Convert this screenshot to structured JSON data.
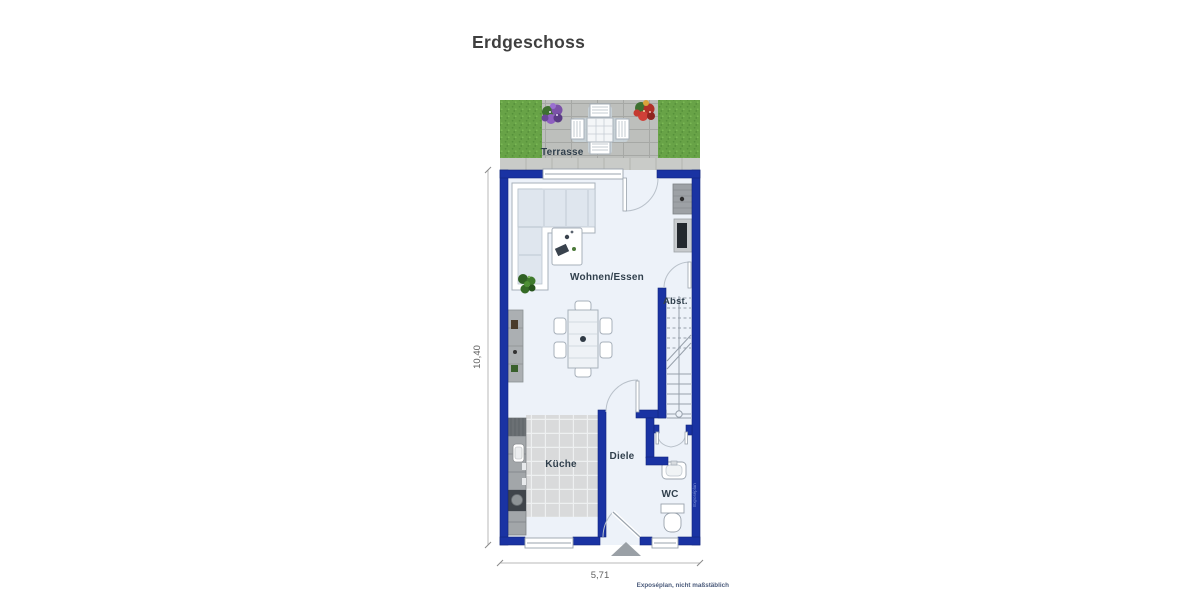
{
  "title": "Erdgeschoss",
  "rooms": {
    "terrasse": "Terrasse",
    "wohnen": "Wohnen/Essen",
    "abst": "Abst.",
    "kueche": "Küche",
    "diele": "Diele",
    "wc": "WC"
  },
  "dimensions": {
    "height": "10,40",
    "width": "5,71"
  },
  "footnote": "Exposéplan, nicht maßstäblich",
  "watermark": "Exposéplan",
  "colors": {
    "wall": "#1a33a3",
    "floor": "#edf2f9",
    "grass": "#68a347",
    "paving": "#bdbfbc",
    "tiles": "#d9dadb"
  }
}
